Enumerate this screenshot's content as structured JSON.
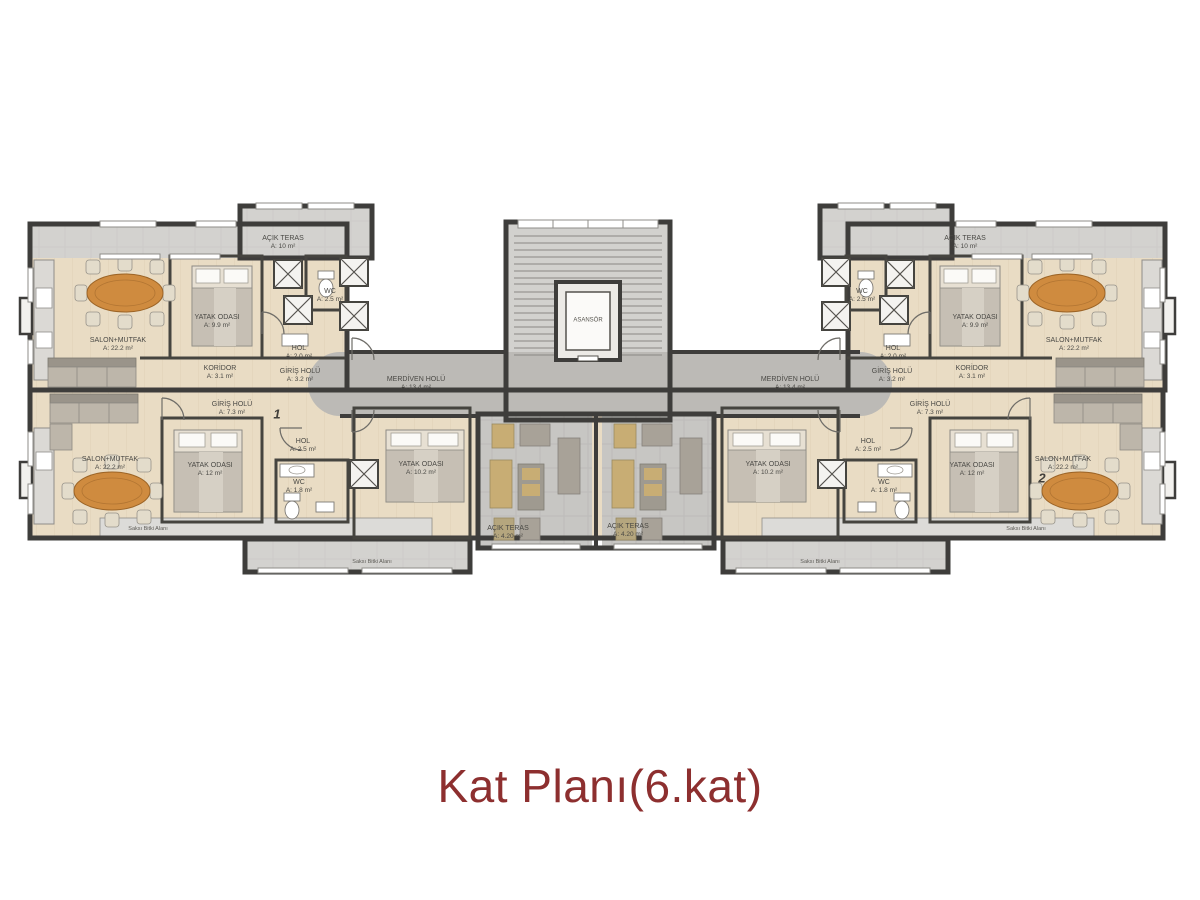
{
  "title": {
    "text": "Kat Planı(6.kat)"
  },
  "colors": {
    "title_red": "#8d2f2f",
    "wall_dark": "#3e3d3b",
    "wood_floor": "#e9dcc4",
    "stone_terrace": "#c7c6c3",
    "corridor_gray": "#bcbab6",
    "dining_table_wood": "#cf8b3f"
  },
  "rooms": {
    "salon": {
      "name": "SALON+MUTFAK",
      "area": "A: 22.2 m²"
    },
    "yatak_small": {
      "name": "YATAK ODASI",
      "area": "A: 9.9 m²"
    },
    "yatak_mid": {
      "name": "YATAK ODASI",
      "area": "A: 12 m²"
    },
    "yatak_buyuk": {
      "name": "YATAK ODASI",
      "area": "A: 10.2 m²"
    },
    "wc_ust": {
      "name": "WC",
      "area": "A: 2.5 m²"
    },
    "wc_alt": {
      "name": "WC",
      "area": "A: 1.8 m²"
    },
    "hol_ust": {
      "name": "HOL",
      "area": "A: 2.0 m²"
    },
    "hol_alt": {
      "name": "HOL",
      "area": "A: 2.5 m²"
    },
    "koridor": {
      "name": "KORİDOR",
      "area": "A: 3.1 m²"
    },
    "giris_ust": {
      "name": "GİRİŞ HOLÜ",
      "area": "A: 3.2 m²"
    },
    "giris_alt": {
      "name": "GİRİŞ HOLÜ",
      "area": "A: 7.3 m²"
    },
    "merdiven": {
      "name": "MERDİVEN HOLÜ",
      "area": "A: 13.4 m²"
    },
    "asansor": {
      "name": "ASANSÖR"
    },
    "teras_ust": {
      "name": "AÇIK TERAS",
      "area": "A: 10 m²"
    },
    "teras_orta": {
      "name": "AÇIK TERAS",
      "area": "A: 4.20 m²"
    },
    "balkon_strip": {
      "text": "Saksı Bitki Alanı"
    }
  },
  "units": {
    "left_no": "1",
    "right_no": "2"
  }
}
